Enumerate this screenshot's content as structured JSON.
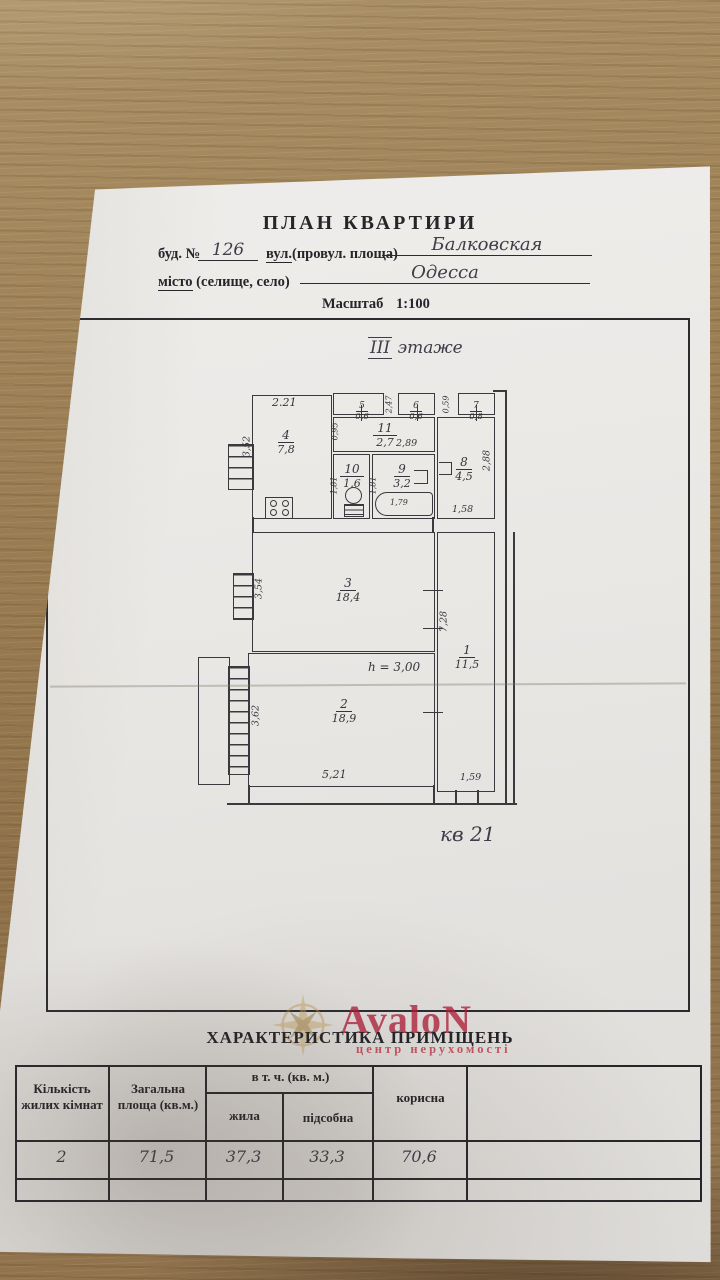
{
  "header": {
    "title": "ПЛАН КВАРТИРИ",
    "building_label": "буд. №",
    "building_value": "126",
    "street_label_underlined": "вул.",
    "street_label_rest": "(провул. площа)",
    "street_value": "Балковская",
    "city_label_underlined": "місто",
    "city_label_rest": " (селище, село)",
    "city_value": "Одесса",
    "scale_label": "Масштаб",
    "scale_value": "1:100"
  },
  "plan": {
    "floor_roman": "III",
    "floor_word": "этаже",
    "apartment_note": "кв 21",
    "height_note": "h = 3,00",
    "rooms": [
      {
        "number": "1",
        "area": "11,5"
      },
      {
        "number": "2",
        "area": "18,9"
      },
      {
        "number": "3",
        "area": "18,4"
      },
      {
        "number": "4",
        "area": "7,8"
      },
      {
        "number": "5",
        "area": "0,6"
      },
      {
        "number": "6",
        "area": "0,6"
      },
      {
        "number": "7",
        "area": "0,8"
      },
      {
        "number": "8",
        "area": "4,5"
      },
      {
        "number": "9",
        "area": "3,2"
      },
      {
        "number": "10",
        "area": "1,6"
      },
      {
        "number": "11",
        "area": "2,7"
      }
    ],
    "dims": {
      "d221": "2.21",
      "d352": "3,52",
      "d247": "2,47",
      "d059": "0,59",
      "d095": "0,95",
      "d289": "2,89",
      "d288": "2,88",
      "d158": "1,58",
      "d181a": "1,81",
      "d181b": "1,81",
      "d179": "1,79",
      "d354": "3,54",
      "d728": "7,28",
      "d362": "3,62",
      "d521": "5,21",
      "d159": "1,59"
    }
  },
  "watermark": {
    "brand": "AvaloN",
    "subtitle": "центр нерухомості"
  },
  "table": {
    "title": "ХАРАКТЕРИСТИКА ПРИМІЩЕНЬ",
    "col_rooms": "Кількість жилих кімнат",
    "col_total": "Загальна площа (кв.м.)",
    "col_group": "в т. ч. (кв. м.)",
    "col_living": "жила",
    "col_aux": "підсобна",
    "col_useful": "корисна",
    "values": {
      "rooms": "2",
      "total": "71,5",
      "living": "37,3",
      "aux": "33,3",
      "useful": "70,6"
    }
  }
}
